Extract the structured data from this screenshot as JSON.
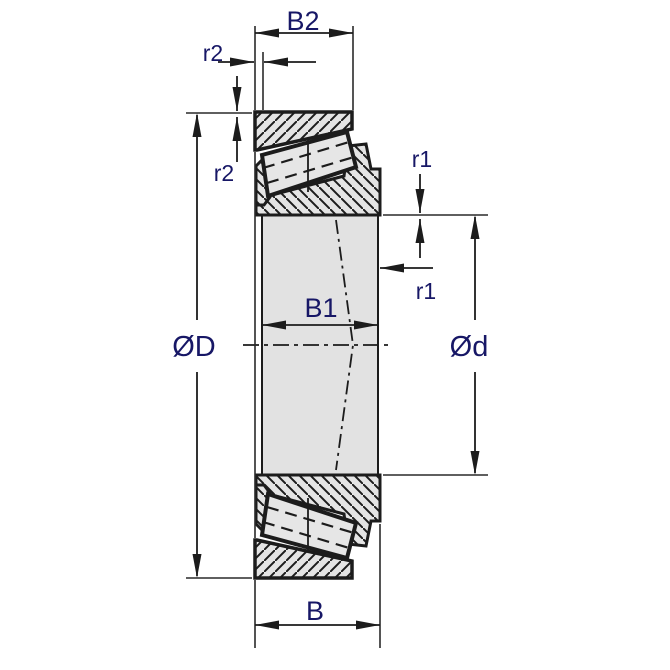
{
  "title": "Tapered roller bearing dimension drawing",
  "labels": {
    "b2": "B2",
    "r2": "r2",
    "r1": "r1",
    "b1": "B1",
    "d_outer": "ØD",
    "d_bore": "Ød",
    "b": "B"
  },
  "colors": {
    "label": "#171766",
    "line": "#1c1c1c",
    "fill_light": "#e4e4e4",
    "background": "#ffffff"
  }
}
